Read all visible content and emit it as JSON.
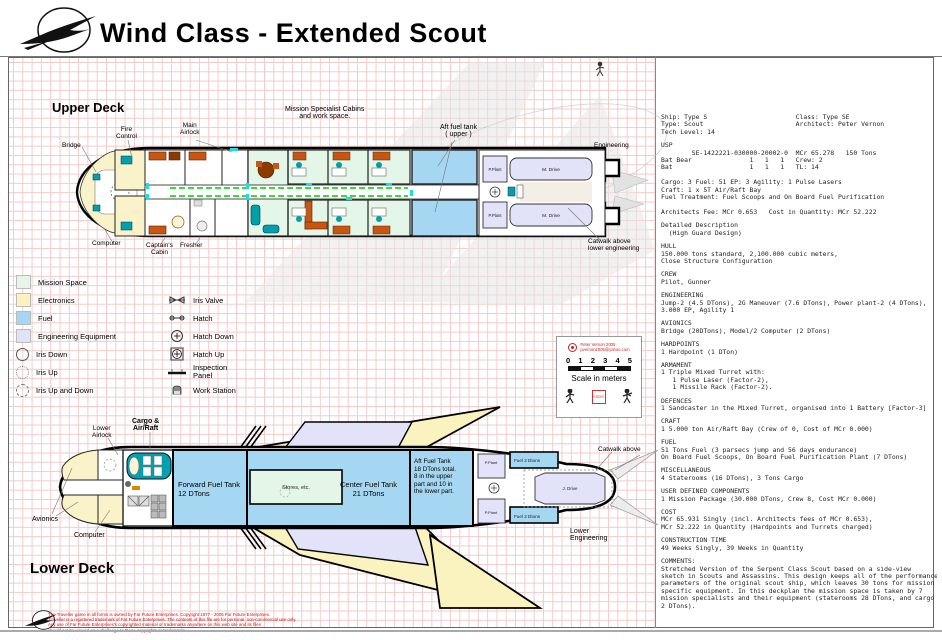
{
  "header": {
    "title": "Wind Class - Extended Scout"
  },
  "upper_deck": {
    "heading": "Upper Deck",
    "labels": {
      "bridge": "Bridge",
      "fire_control": "Fire\nControl",
      "main_airlock": "Main\nAirlock",
      "mission": "Mission Specialist Cabins\nand work space.",
      "aft_fuel": "Aft fuel tank\n( upper )",
      "engineering": "Engineering",
      "catwalk": "Catwalk above\nlower engineering",
      "computer": "Computer",
      "captains_cabin": "Captain's\nCabin",
      "fresher": "Fresher",
      "p_plant": "P.Plant",
      "m_drive": "M. Drive"
    }
  },
  "lower_deck": {
    "heading": "Lower Deck",
    "labels": {
      "lower_airlock": "Lower\nAirlock",
      "cargo_airraft": "Cargo &\nAir/Raft",
      "avionics": "Avionics",
      "computer": "Computer",
      "forward_fuel": "Forward Fuel Tank\n12 DTons",
      "stores": "Stores, etc.",
      "center_fuel": "Center Fuel Tank\n21 DTons",
      "aft_fuel": "Aft Fuel Tank\n18 DTons total.\n8 in the upper\npart and 10 in\nthe lower part.",
      "p_plant": "P.Plant",
      "fuel2": "Fuel 2 Dtons",
      "j_drive": "J. Drive",
      "catwalk": "Catwalk above",
      "lower_engineering": "Lower\nEngineering"
    }
  },
  "legend": {
    "left": [
      {
        "label": "Mission Space",
        "color": "#e3f6e8"
      },
      {
        "label": "Electronics",
        "color": "#fbf2c0"
      },
      {
        "label": "Fuel",
        "color": "#a6d7f2"
      },
      {
        "label": "Engineering Equipment",
        "color": "#e2e2f8"
      },
      {
        "label": "Iris Down"
      },
      {
        "label": "Iris Up"
      },
      {
        "label": "Iris Up and Down"
      }
    ],
    "right": [
      {
        "label": "Iris Valve"
      },
      {
        "label": "Hatch"
      },
      {
        "label": "Hatch Down"
      },
      {
        "label": "Hatch Up"
      },
      {
        "label": "Inspection\nPanel"
      },
      {
        "label": "Work Station"
      }
    ]
  },
  "scale_box": {
    "credit_line1": "Peter Vernon 2005",
    "credit_line2": "pvernon2005@yahoo.com",
    "ticks": [
      "0",
      "1",
      "2",
      "3",
      "4",
      "5"
    ],
    "caption": "Scale in meters",
    "stamp": "SSDS"
  },
  "stats": {
    "id": "Ship: Type S                       Class: Type SE\nType: Scout                        Architect: Peter Vernon\nTech Level: 14",
    "usp": "USP\n        SE-1422221-030000-20002-0  MCr 65.278   150 Tons\nBat Bear               1   1   1   Crew: 2\nBat                    1   1   1   TL: 14\n\nCargo: 3 Fuel: 51 EP: 3 Agility: 1 Pulse Lasers\nCraft: 1 x 5T Air/Raft Bay\nFuel Treatment: Fuel Scoops and On Board Fuel Purification\n\nArchitects Fee: MCr 0.653   Cost in Quantity: MCr 52.222",
    "detailed": "Detailed Description\n  (High Guard Design)",
    "hull": "HULL\n150.000 tons standard, 2,100.000 cubic meters,\nClose Structure Configuration",
    "crew": "CREW\nPilot, Gunner",
    "engineering": "ENGINEERING\nJump-2 (4.5 DTons), 2G Maneuver (7.6 DTons), Power plant-2 (4 DTons),\n3.000 EP, Agility 1",
    "avionics": "AVIONICS\nBridge (20DTons), Model/2 Computer (2 DTons)",
    "hardpoints": "HARDPOINTS\n1 Hardpoint (1 DTon)",
    "armament": "ARMAMENT\n1 Triple Mixed Turret with:\n   1 Pulse Laser (Factor-2),\n   1 Missile Rack (Factor-2).",
    "defences": "DEFENCES\n1 Sandcaster in the Mixed Turret, organised into 1 Battery [Factor-3]",
    "craft": "CRAFT\n1 5.000 ton Air/Raft Bay (Crew of 0, Cost of MCr 0.000)",
    "fuel": "FUEL\n51 Tons Fuel (3 parsecs jump and 56 days endurance)\nOn Board Fuel Scoops, On Board Fuel Purification Plant (7 DTons)",
    "miscellaneous": "MISCELLANEOUS\n4 Staterooms (16 DTons), 3 Tons Cargo",
    "user_defined": "USER DEFINED COMPONENTS\n1 Mission Package (30.000 DTons, Crew 8, Cost MCr 0.000)",
    "cost": "COST\nMCr 65.931 Singly (incl. Architects fees of MCr 0.653),\nMCr 52.222 in Quantity (Hardpoints and Turrets charged)",
    "construction": "CONSTRUCTION TIME\n49 Weeks Singly, 39 Weeks in Quantity",
    "comments": "COMMENTS:\nStretched Version of the Serpent Class Scout based on a side-view\nsketch in Scouts and Assassins. This design keeps all of the performance\nparameters of the original scout ship, which leaves 30 tons for mission\nspecific equipment. In this deckplan the mission space is taken by 7\nmission specialists and their equipment (staterooms 28 DTons, and cargo\n2 DTons)."
  },
  "footer": {
    "disclaimer": "The Traveller game in all forms is owned by Far Future Enterprises. Copyright 1977 - 2005 Far Future Enterprises.\nTraveller is a registered trademark of Far Future Enterprises. The contents of this file are for personal, non-commercial use only.\nAny use of Far Future Enterprises's copyrighted material or trademarks anywhere on this web site and its files\nshould not be viewed as a challenge to those copyrights or trademarks."
  },
  "colors": {
    "mission_space": "#e3f6e8",
    "electronics": "#fbf2c0",
    "fuel": "#a6d7f2",
    "engineering_equipment": "#e2e2f8",
    "corridor_green": "#00cc00",
    "furniture_orange": "#c85510",
    "console_teal": "#00a0a8",
    "fineprint_red": "#cc1111",
    "grid_pink": "#f4caca"
  }
}
